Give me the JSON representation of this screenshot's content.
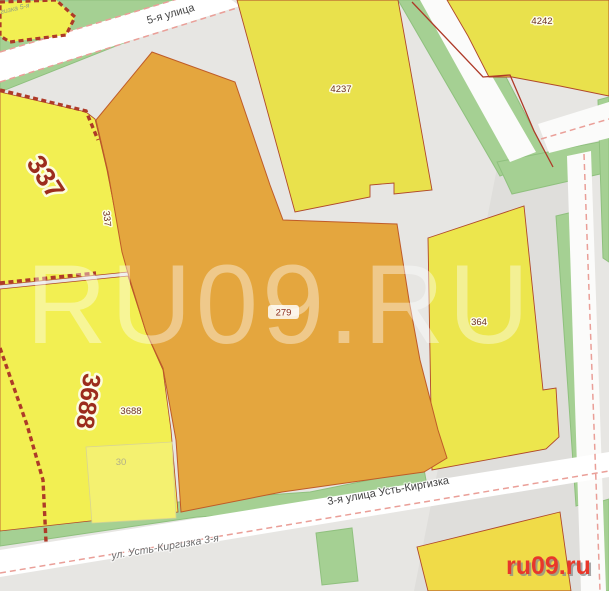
{
  "watermark": {
    "text": "RU09.RU"
  },
  "logo": {
    "text": "ru09.ru"
  },
  "streets": {
    "fifth_street": "5-я улица",
    "third_street_ust_kirgizka": "3-я улица Усть-Киргизка",
    "ust_kirgizka_3rd": "ул. Усть-Киргизка 3-я",
    "kirgizka_5th_partial": "гизка 5-я"
  },
  "parcels": {
    "selected_279": {
      "number": "279"
    },
    "block_337": {
      "number_large": "337",
      "number_small": "337"
    },
    "block_3688": {
      "number_large": "3688",
      "number_small": "3688"
    },
    "block_4237": {
      "number": "4237"
    },
    "block_4242": {
      "number": "4242"
    },
    "block_364": {
      "number": "364"
    },
    "building_30": {
      "number": "30"
    }
  },
  "colors": {
    "parcel_yellow": "#f2ef52",
    "parcel_yellow_muted": "#e9e14c",
    "parcel_yellow_gold": "#f0db48",
    "selected_orange": "#e4a63e",
    "boundary_red": "#ae3a28",
    "vegetation_green": "#a5d093",
    "road_gray": "#e7e6e3",
    "road_white": "#ffffff",
    "road_edge_pink": "#ea9f98",
    "watermark_white": "rgba(255,255,255,0.40)",
    "logo_red": "#e8372b"
  }
}
